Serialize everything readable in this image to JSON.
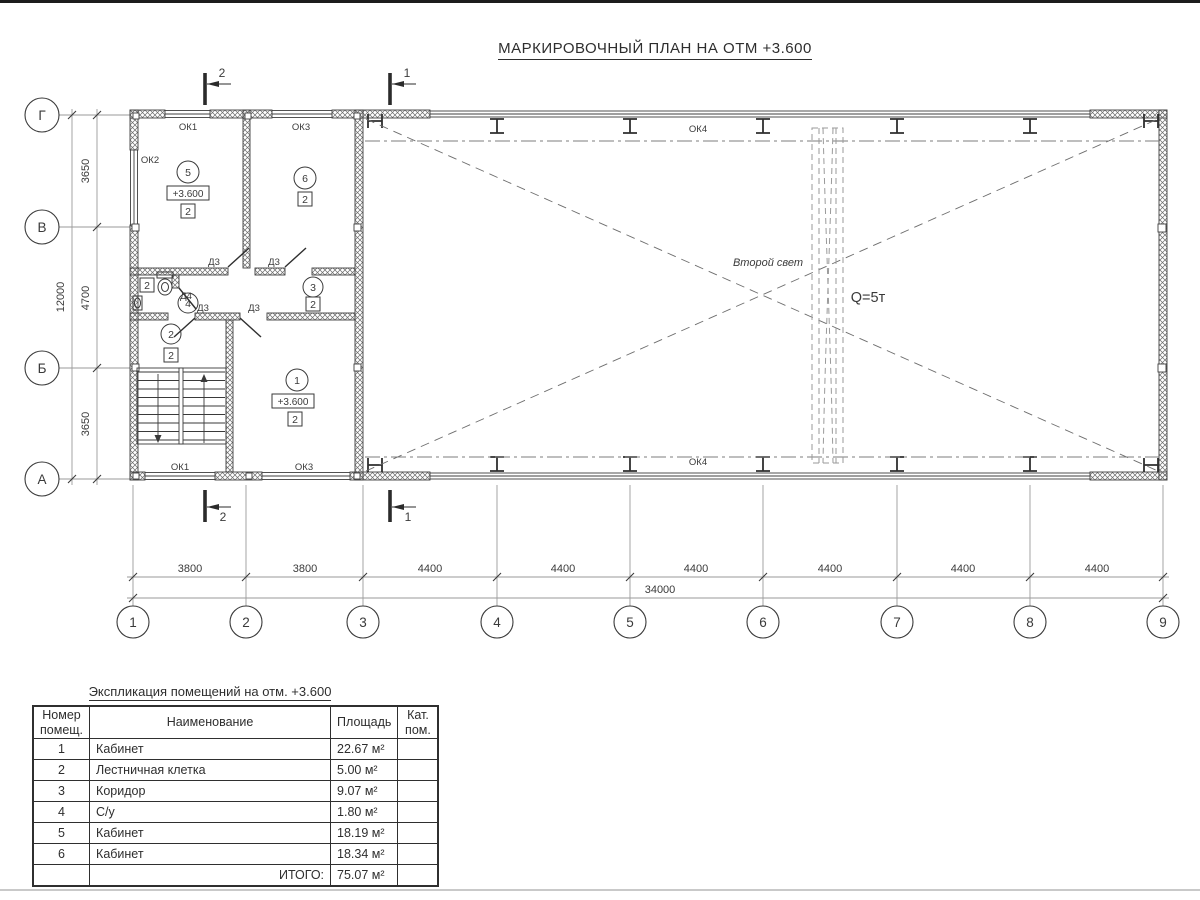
{
  "sheet": {
    "title": "МАРКИРОВОЧНЫЙ ПЛАН НА ОТМ +3.600",
    "ink_color": "#3a3a3a",
    "faint_line_color": "#9a9a9a"
  },
  "plan": {
    "axes_rows": [
      "Г",
      "В",
      "Б",
      "А"
    ],
    "axes_cols": [
      "1",
      "2",
      "3",
      "4",
      "5",
      "6",
      "7",
      "8",
      "9"
    ],
    "dims_bottom": [
      "3800",
      "3800",
      "4400",
      "4400",
      "4400",
      "4400",
      "4400",
      "4400"
    ],
    "dim_bottom_total": "34000",
    "dims_left": [
      "3650",
      "4700",
      "3650"
    ],
    "dim_left_total": "12000",
    "sections": {
      "s1": "1",
      "s2": "2"
    },
    "labels": {
      "ok1": "ОК1",
      "ok2": "ОК2",
      "ok3": "ОК3",
      "ok4": "ОК4",
      "d3": "Д3",
      "d4": "Д4"
    },
    "hall": {
      "second_light": "Второй свет",
      "crane": "Q=5т"
    },
    "rooms": [
      {
        "num": "1",
        "elev": "+3.600",
        "cat": "2"
      },
      {
        "num": "2",
        "cat": "2"
      },
      {
        "num": "3",
        "cat": "2"
      },
      {
        "num": "4",
        "cat": "2"
      },
      {
        "num": "5",
        "elev": "+3.600",
        "cat": "2"
      },
      {
        "num": "6",
        "cat": "2"
      }
    ]
  },
  "schedule": {
    "title": "Экспликация помещений на отм. +3.600",
    "col_number_line1": "Номер",
    "col_number_line2": "помещ.",
    "col_name": "Наименование",
    "col_area": "Площадь",
    "col_cat_line1": "Кат.",
    "col_cat_line2": "пом.",
    "rows": [
      {
        "num": "1",
        "name": "Кабинет",
        "area": "22.67 м²"
      },
      {
        "num": "2",
        "name": "Лестничная клетка",
        "area": "5.00 м²"
      },
      {
        "num": "3",
        "name": "Коридор",
        "area": "9.07 м²"
      },
      {
        "num": "4",
        "name": "С/у",
        "area": "1.80 м²"
      },
      {
        "num": "5",
        "name": "Кабинет",
        "area": "18.19 м²"
      },
      {
        "num": "6",
        "name": "Кабинет",
        "area": "18.34 м²"
      }
    ],
    "total_label": "ИТОГО:",
    "total_area": "75.07 м²"
  }
}
